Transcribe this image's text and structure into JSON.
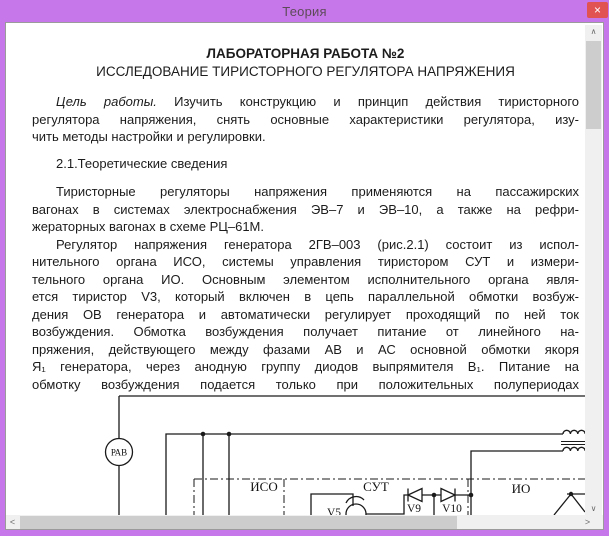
{
  "window": {
    "title": "Теория",
    "close_glyph": "×"
  },
  "colors": {
    "titlebar": "#c678ea",
    "close_button": "#e15252",
    "scroll_track": "#f0f0f0",
    "scroll_thumb": "#cdcdcd",
    "text": "#1c1c1c"
  },
  "document": {
    "heading_line1": "ЛАБОРАТОРНАЯ РАБОТА №2",
    "heading_line2": "ИССЛЕДОВАНИЕ ТИРИСТОРНОГО РЕГУЛЯТОРА НАПРЯЖЕНИЯ",
    "goal": {
      "lead_italic": "Цель работы.",
      "lead_rest": " Изучить конструкцию и принцип действия тиристорного",
      "lines": [
        "регулятора напряжения, снять основные характеристики регулятора, изу-",
        "чить методы настройки и регулировки."
      ]
    },
    "section_heading": "2.1.Теоретические сведения",
    "para_intro_lines": [
      "Тиристорные регуляторы напряжения применяются на пассажирских",
      "вагонах в системах электроснабжения ЭВ–7 и ЭВ–10, а также на рефри-",
      "жераторных вагонах в схеме РЦ–61М."
    ],
    "para_regulator_lines": [
      "Регулятор напряжения генератора 2ГВ–003 (рис.2.1) состоит из испол-",
      "нительного органа ИСО, системы управления тиристором СУТ и измери-",
      "тельного органа ИО. Основным элементом исполнительного органа явля-",
      "ется тиристор V3, который включен в цепь параллельной обмотки возбуж-",
      "дения ОВ генератора и автоматически регулирует проходящий по ней ток",
      "возбуждения. Обмотка возбуждения получает питание от линейного на-",
      "пряжения, действующего между фазами АВ и АС основной обмотки якоря",
      "Я₁ генератора, через анодную группу диодов выпрямителя В₁. Питание на",
      "обмотку возбуждения подается только при положительных полупериодах"
    ]
  },
  "diagram": {
    "labels": {
      "meter": "РАВ",
      "block_iso": "ИСО",
      "block_sut": "СУТ",
      "block_io": "ИО",
      "thyristor": "V5",
      "diode_left": "V9",
      "diode_right": "V10"
    }
  },
  "scrollbars": {
    "up_glyph": "∧",
    "down_glyph": "∨",
    "left_glyph": "<",
    "right_glyph": ">"
  }
}
